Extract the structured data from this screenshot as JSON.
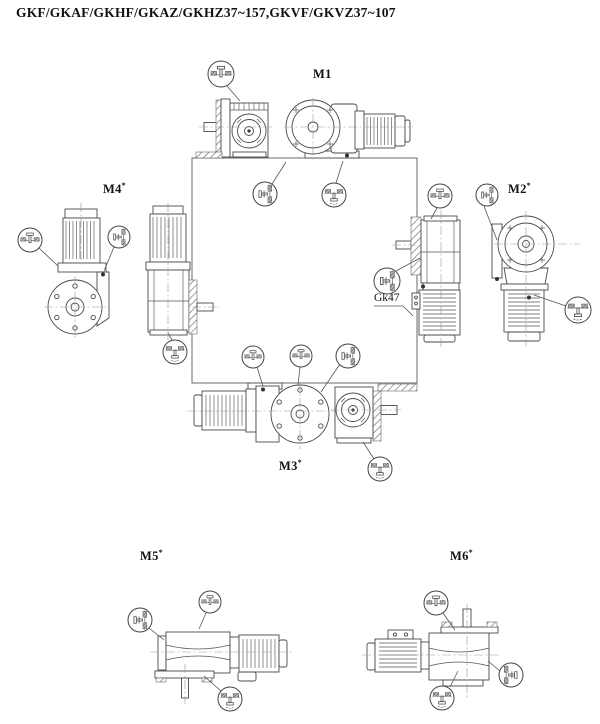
{
  "title": "GKF/GKAF/GKHF/GKAZ/GKHZ37~157,GKVF/GKVZ37~107",
  "positions": {
    "m1": {
      "label": "M1",
      "sup": ""
    },
    "m2": {
      "label": "M2",
      "sup": "*"
    },
    "m3": {
      "label": "M3",
      "sup": "*"
    },
    "m4": {
      "label": "M4",
      "sup": "*"
    },
    "m5": {
      "label": "M5",
      "sup": "*"
    },
    "m6": {
      "label": "M6",
      "sup": "*"
    }
  },
  "annotations": {
    "gk47": "Gk47"
  },
  "icons": {
    "vent_plug": "vent-plug-icon",
    "side_plug": "side-oil-plug-icon",
    "drain_plug": "drain-plug-icon"
  },
  "colors": {
    "line": "#4a4a4a",
    "hatch": "#777777",
    "background": "#ffffff",
    "text": "#111111"
  }
}
